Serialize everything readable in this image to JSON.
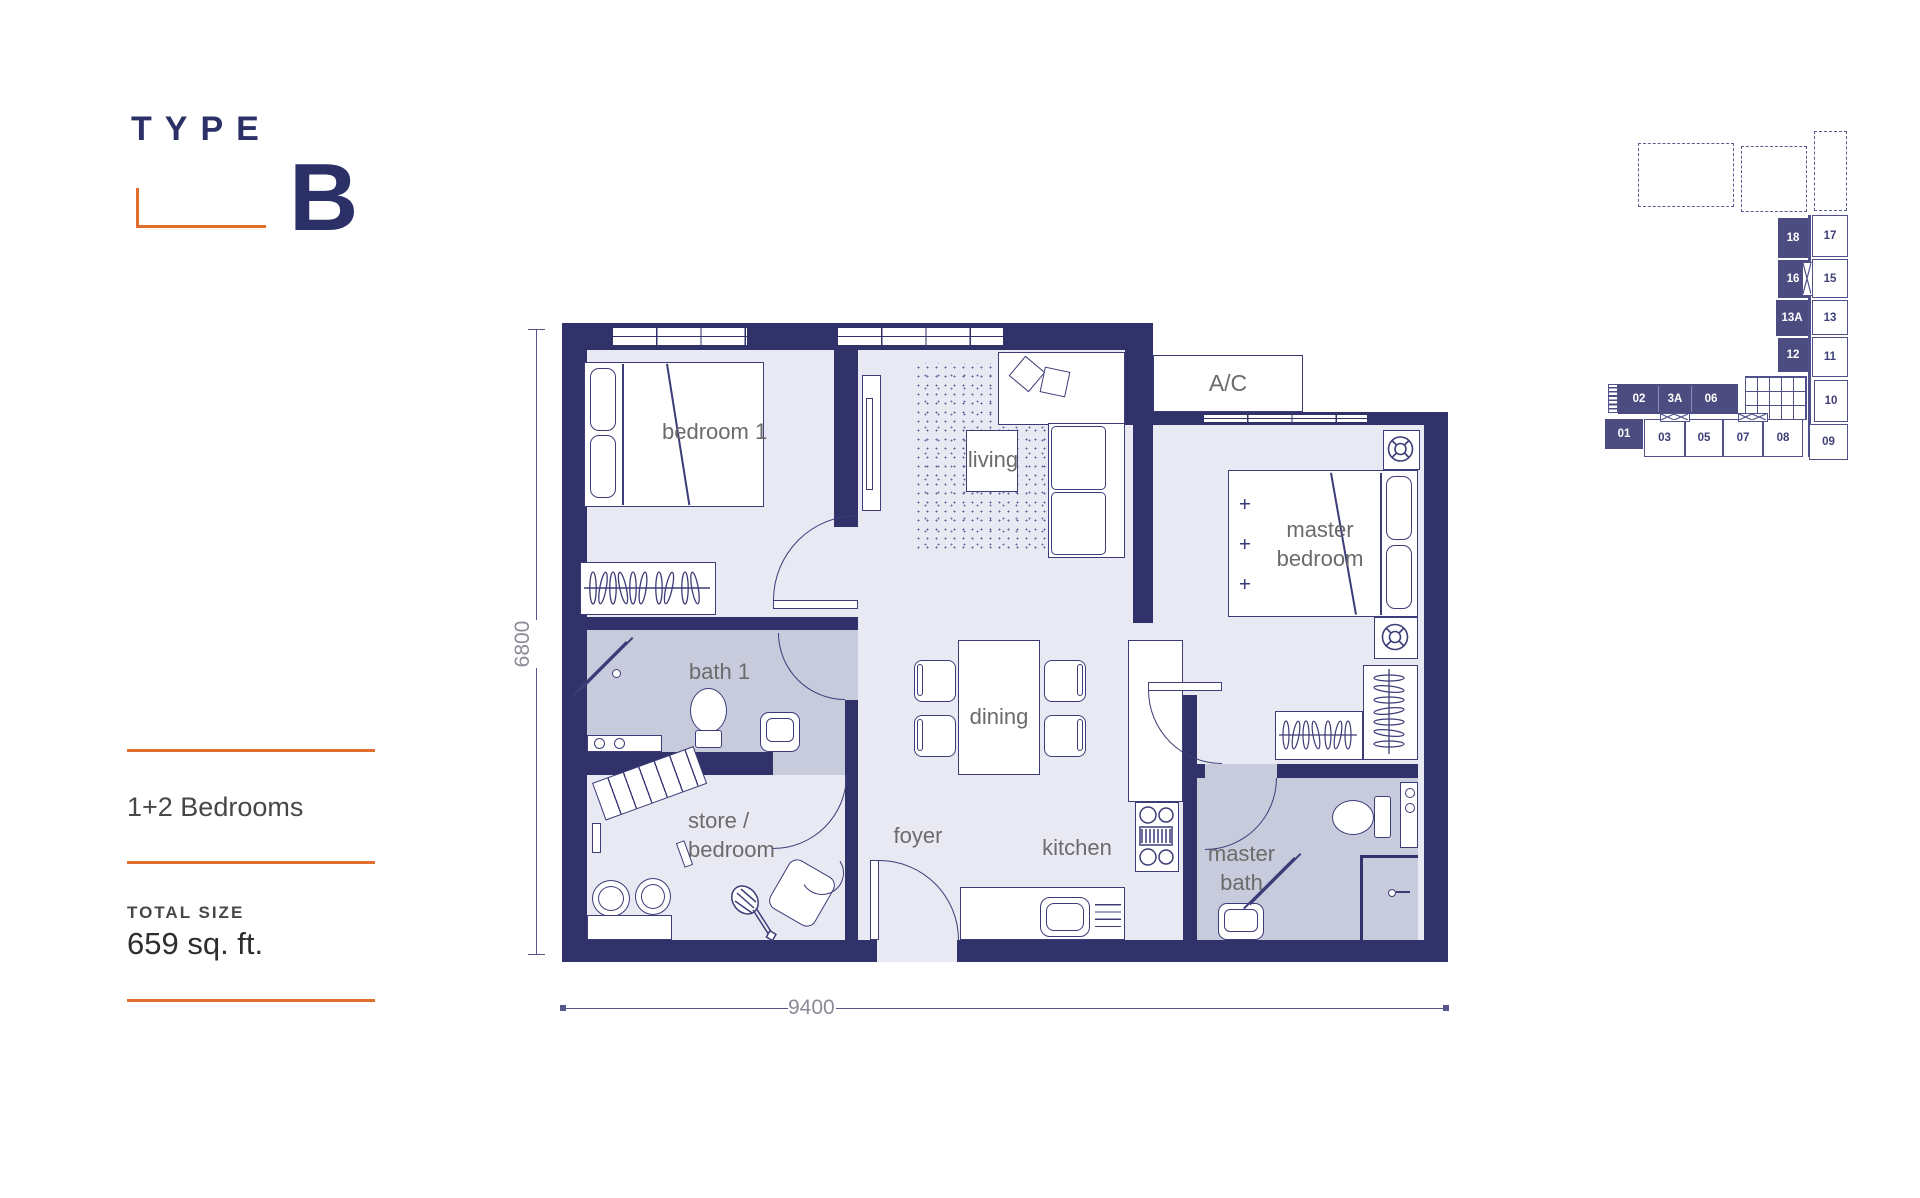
{
  "title": {
    "type_label": "TYPE",
    "type_letter": "B"
  },
  "info": {
    "bedrooms": "1+2 Bedrooms",
    "total_size_label": "TOTAL SIZE",
    "total_size_value": "659 sq. ft."
  },
  "dimensions": {
    "width_mm": "9400",
    "height_mm": "6800"
  },
  "rooms": {
    "bedroom1": "bedroom 1",
    "living": "living",
    "ac": "A/C",
    "master_bedroom": "master bedroom",
    "bath1": "bath 1",
    "dining": "dining",
    "store": "store / bedroom",
    "foyer": "foyer",
    "kitchen": "kitchen",
    "master_bath": "master bath"
  },
  "keyplan": {
    "stack_filled": [
      "18",
      "16",
      "13A",
      "12"
    ],
    "stack_outline": [
      "17",
      "15",
      "13",
      "11",
      "10",
      "09"
    ],
    "row_filled": [
      "02",
      "3A",
      "06"
    ],
    "unit_01": "01",
    "row_outline": [
      "03",
      "05",
      "07",
      "08"
    ]
  },
  "colors": {
    "wall_navy": "#32326b",
    "accent_orange": "#e06f2f",
    "room_fill": "#e9e9f4",
    "wet_room_fill": "#c8cbdb",
    "keyplan_filled": "#4c4c80",
    "label_gray": "#6b6b6b"
  }
}
